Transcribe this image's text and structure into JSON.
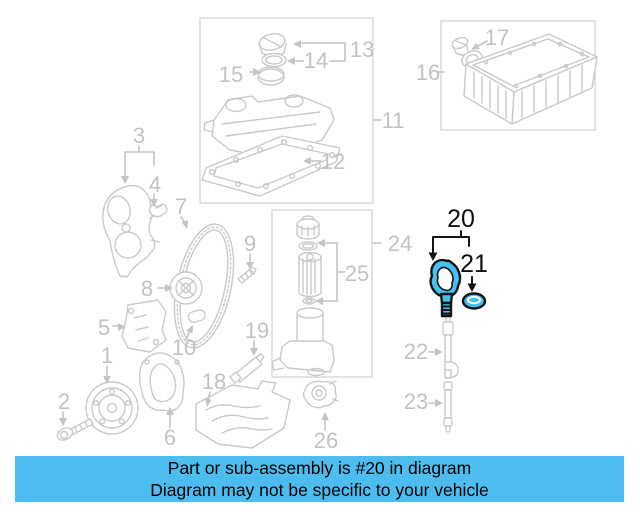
{
  "banner": {
    "line1": "Part or sub-assembly is #20 in diagram",
    "line2": "Diagram may not be specific to your vehicle",
    "background_color": "#4DBCEE",
    "text_color": "#000000"
  },
  "diagram": {
    "type": "exploded-parts-diagram",
    "highlighted_parts": [
      "20",
      "21"
    ],
    "gray_color": "#C9C9C9",
    "highlight_fill_color": "#45C1F1",
    "highlight_outline_color": "#141414",
    "callouts": [
      {
        "label": "1"
      },
      {
        "label": "2"
      },
      {
        "label": "3"
      },
      {
        "label": "4"
      },
      {
        "label": "5"
      },
      {
        "label": "6"
      },
      {
        "label": "7"
      },
      {
        "label": "8"
      },
      {
        "label": "9"
      },
      {
        "label": "10"
      },
      {
        "label": "11"
      },
      {
        "label": "12"
      },
      {
        "label": "13"
      },
      {
        "label": "14"
      },
      {
        "label": "15"
      },
      {
        "label": "16"
      },
      {
        "label": "17"
      },
      {
        "label": "18"
      },
      {
        "label": "19"
      },
      {
        "label": "20"
      },
      {
        "label": "21"
      },
      {
        "label": "22"
      },
      {
        "label": "23"
      },
      {
        "label": "24"
      },
      {
        "label": "25"
      },
      {
        "label": "26"
      }
    ]
  }
}
